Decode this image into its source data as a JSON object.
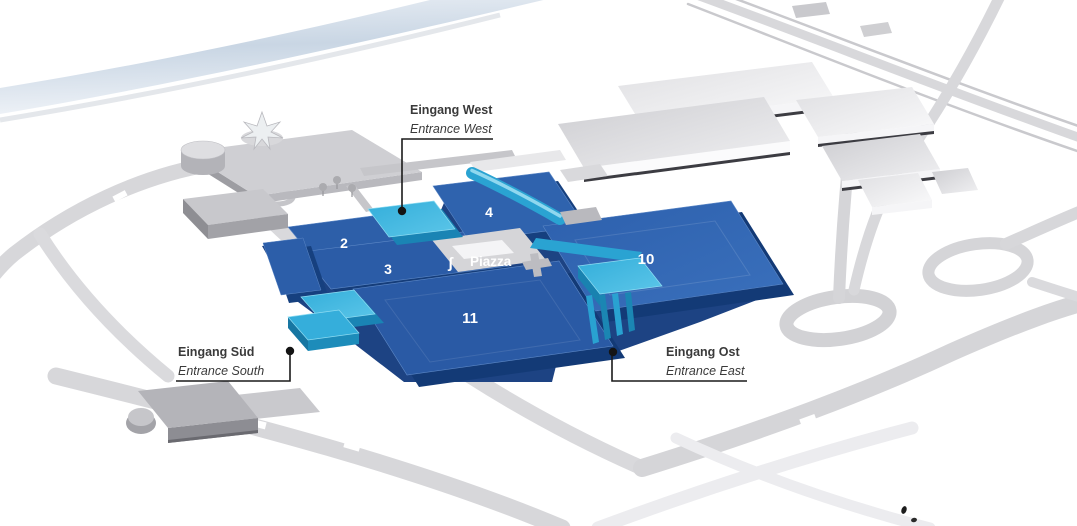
{
  "map": {
    "halls": [
      {
        "number": "2"
      },
      {
        "number": "3"
      },
      {
        "number": "4"
      },
      {
        "number": "10"
      },
      {
        "number": "11"
      }
    ],
    "piazza": {
      "label": "Piazza"
    },
    "entrances": [
      {
        "id": "west",
        "name_de": "Eingang West",
        "name_en": "Entrance West"
      },
      {
        "id": "south",
        "name_de": "Eingang Süd",
        "name_en": "Entrance South"
      },
      {
        "id": "east",
        "name_de": "Eingang Ost",
        "name_en": "Entrance East"
      }
    ],
    "colors": {
      "hall_blue": "#2d5fa9",
      "hall_blue_dark": "#16407f",
      "entrance_cyan": "#2aa6d5",
      "entrance_cyan_light": "#5cc6e9",
      "building_gray": "#cfcfd3",
      "road_gray": "#d7d7da",
      "river_blue": "#c9d6e4",
      "label_text": "#3a3a3a",
      "hall_number_text": "#ffffff"
    }
  }
}
